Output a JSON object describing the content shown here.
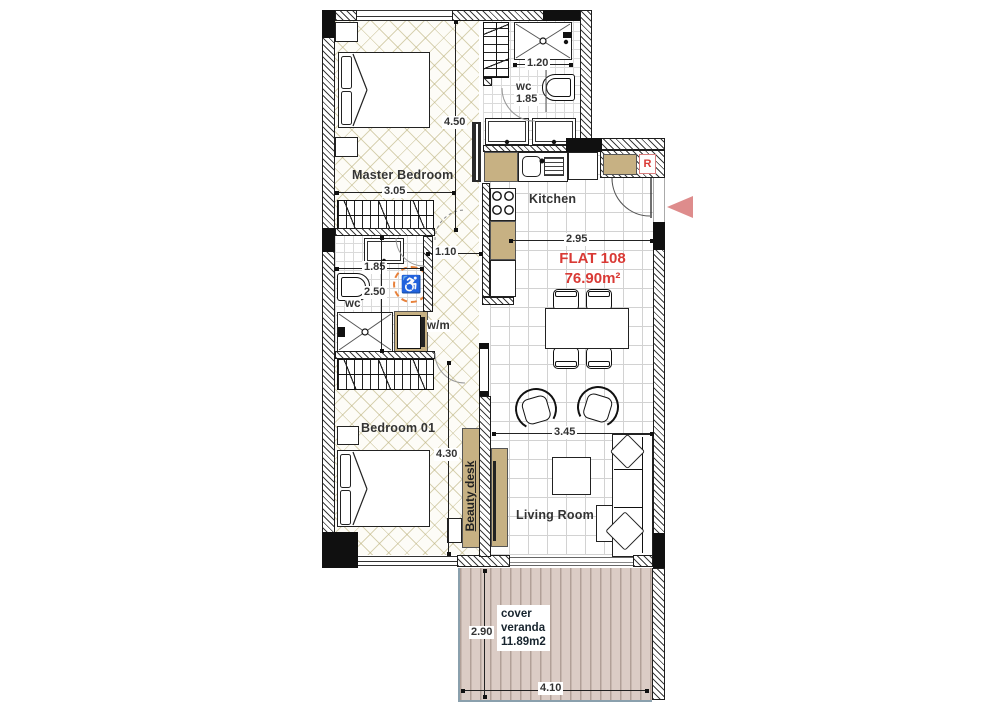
{
  "title": {
    "name": "FLAT 108",
    "area": "76.90m²"
  },
  "rooms": {
    "master_bedroom": "Master Bedroom",
    "kitchen": "Kitchen",
    "bedroom_01": "Bedroom 01",
    "living_room": "Living Room",
    "wc_top": "wc",
    "wc_mid": "wc",
    "washing_machine": "w/m",
    "beauty_desk": "Beauty desk",
    "fridge": "R"
  },
  "veranda": {
    "line1": "cover",
    "line2": "veranda",
    "line3": "11.89m2"
  },
  "dims": {
    "d120": "1.20",
    "d185top": "1.85",
    "d450": "4.50",
    "d305": "3.05",
    "d110": "1.10",
    "d185mid": "1.85",
    "d250": "2.50",
    "d295": "2.95",
    "d345": "3.45",
    "d430": "4.30",
    "d290": "2.90",
    "d410": "4.10"
  },
  "symbols": {
    "wheelchair": "♿"
  },
  "colors": {
    "accent_red": "#d93a35",
    "cabinet_tan": "#c7b183",
    "deck": "#dbccc5",
    "deck_edge": "#8aa0ad",
    "entrance_arrow": "#de8c8c",
    "accessibility_orange": "#e8823c"
  }
}
